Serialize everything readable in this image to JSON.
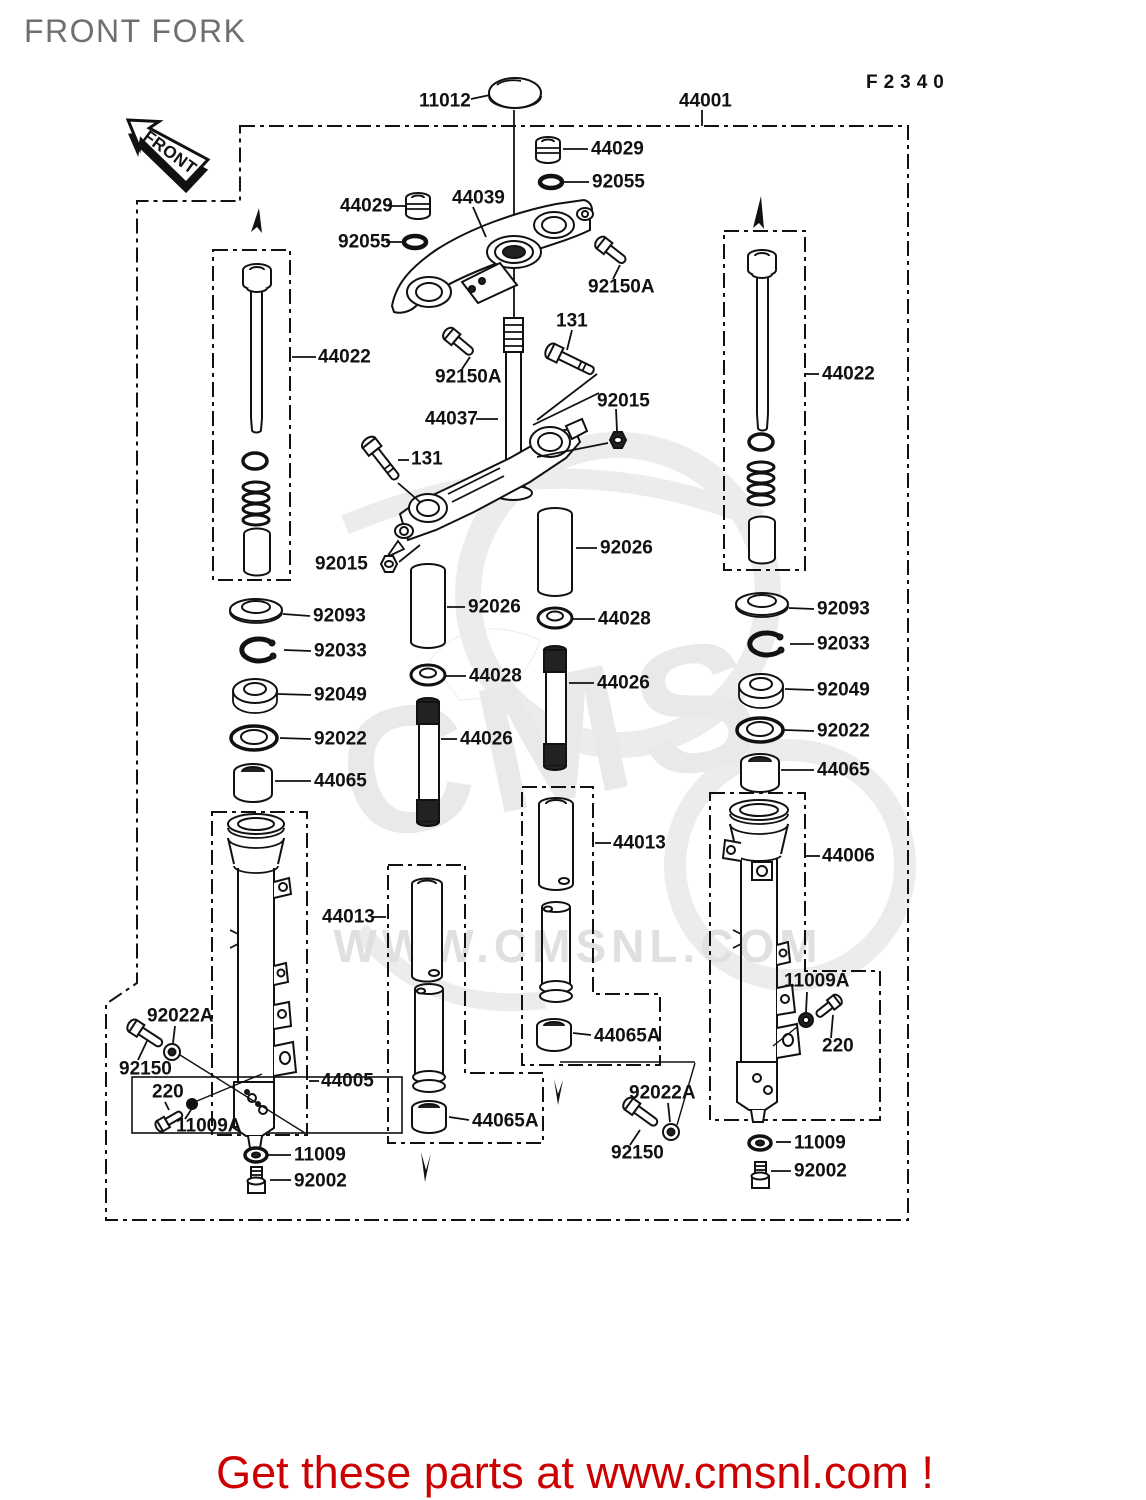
{
  "diagram": {
    "title": "FRONT FORK",
    "figure_code": "F2340",
    "front_arrow_text": "FRONT",
    "watermark": {
      "logo": "CMS",
      "url": "WWW.CMSNL.COM"
    },
    "footer": {
      "text": "Get these parts at www.cmsnl.com !",
      "color": "#cc0000"
    },
    "part_labels": [
      {
        "ref": "11012",
        "text": "11012"
      },
      {
        "ref": "44001",
        "text": "44001"
      },
      {
        "ref": "44029-right",
        "text": "44029"
      },
      {
        "ref": "92055-right",
        "text": "92055"
      },
      {
        "ref": "44029-left",
        "text": "44029"
      },
      {
        "ref": "44039",
        "text": "44039"
      },
      {
        "ref": "92055-left",
        "text": "92055"
      },
      {
        "ref": "92150A-right",
        "text": "92150A"
      },
      {
        "ref": "131-top",
        "text": "131"
      },
      {
        "ref": "44022-left",
        "text": "44022"
      },
      {
        "ref": "92150A-left",
        "text": "92150A"
      },
      {
        "ref": "44037",
        "text": "44037"
      },
      {
        "ref": "92015-right",
        "text": "92015"
      },
      {
        "ref": "44022-right",
        "text": "44022"
      },
      {
        "ref": "131-left",
        "text": "131"
      },
      {
        "ref": "92026-right",
        "text": "92026"
      },
      {
        "ref": "92015-left",
        "text": "92015"
      },
      {
        "ref": "92026-left",
        "text": "92026"
      },
      {
        "ref": "44028-right",
        "text": "44028"
      },
      {
        "ref": "92093-left",
        "text": "92093"
      },
      {
        "ref": "92033-left",
        "text": "92033"
      },
      {
        "ref": "44028-left",
        "text": "44028"
      },
      {
        "ref": "44026-right",
        "text": "44026"
      },
      {
        "ref": "92049-left",
        "text": "92049"
      },
      {
        "ref": "92022-left",
        "text": "92022"
      },
      {
        "ref": "44026-left",
        "text": "44026"
      },
      {
        "ref": "44065-left",
        "text": "44065"
      },
      {
        "ref": "92093-right",
        "text": "92093"
      },
      {
        "ref": "92033-right",
        "text": "92033"
      },
      {
        "ref": "92049-right",
        "text": "92049"
      },
      {
        "ref": "92022-right",
        "text": "92022"
      },
      {
        "ref": "44065-right",
        "text": "44065"
      },
      {
        "ref": "44013-left",
        "text": "44013"
      },
      {
        "ref": "44013-center",
        "text": "44013"
      },
      {
        "ref": "44006",
        "text": "44006"
      },
      {
        "ref": "11009A-right",
        "text": "11009A"
      },
      {
        "ref": "220-right",
        "text": "220"
      },
      {
        "ref": "92022A-left",
        "text": "92022A"
      },
      {
        "ref": "92150-left",
        "text": "92150"
      },
      {
        "ref": "220-left",
        "text": "220"
      },
      {
        "ref": "11009A-left",
        "text": "11009A"
      },
      {
        "ref": "44005",
        "text": "44005"
      },
      {
        "ref": "11009-left",
        "text": "11009"
      },
      {
        "ref": "92002-left",
        "text": "92002"
      },
      {
        "ref": "44065A-left",
        "text": "44065A"
      },
      {
        "ref": "44065A-center",
        "text": "44065A"
      },
      {
        "ref": "92022A-right",
        "text": "92022A"
      },
      {
        "ref": "92150-right",
        "text": "92150"
      },
      {
        "ref": "11009-right",
        "text": "11009"
      },
      {
        "ref": "92002-right",
        "text": "92002"
      }
    ]
  }
}
